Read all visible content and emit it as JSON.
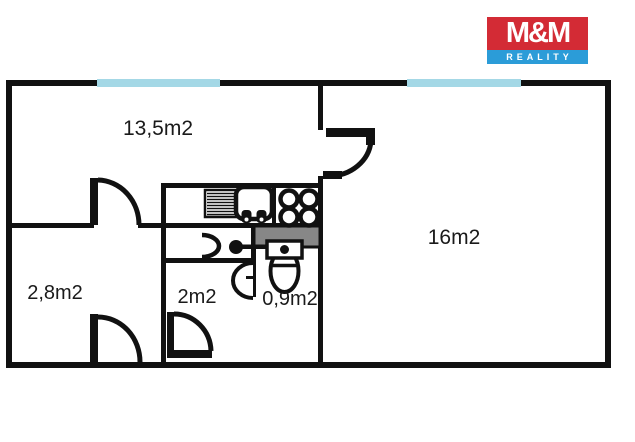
{
  "logo": {
    "mm": "M&M",
    "reality": "REALITY",
    "red": "#d32b35",
    "blue": "#2b9cd8"
  },
  "floorplan": {
    "rooms": [
      {
        "id": "living-room",
        "label": "13,5m2"
      },
      {
        "id": "bedroom",
        "label": "16m2"
      },
      {
        "id": "entry-hall",
        "label": "2,8m2"
      },
      {
        "id": "bathroom",
        "label": "2m2"
      },
      {
        "id": "wc",
        "label": "0,9m2"
      }
    ],
    "colors": {
      "wall": "#111111",
      "window": "#a4d8e6",
      "partition": "#878787",
      "label_text": "#1a1a1a",
      "background": "#ffffff"
    },
    "symbols": [
      "window",
      "door-swing",
      "kitchen-sink",
      "stove-burners",
      "radiator-hatch",
      "toilet",
      "washbasin"
    ]
  }
}
